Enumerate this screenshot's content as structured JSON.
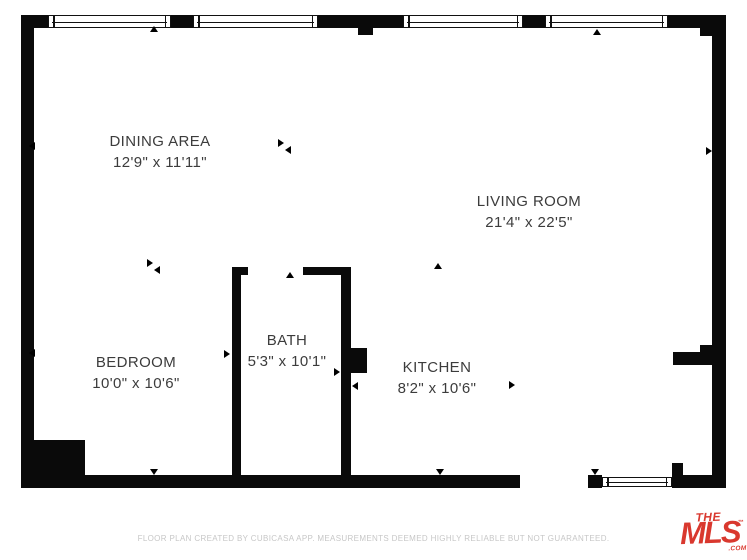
{
  "plan": {
    "rooms": [
      {
        "name": "DINING AREA",
        "dims": "12'9\" x 11'11\""
      },
      {
        "name": "LIVING ROOM",
        "dims": "21'4\" x 22'5\""
      },
      {
        "name": "BEDROOM",
        "dims": "10'0\" x 10'6\""
      },
      {
        "name": "BATH",
        "dims": "5'3\" x 10'1\""
      },
      {
        "name": "KITCHEN",
        "dims": "8'2\" x 10'6\""
      }
    ]
  },
  "footer": {
    "disclaimer": "FLOOR PLAN CREATED BY CUBICASA APP. MEASUREMENTS DEEMED HIGHLY RELIABLE BUT NOT GUARANTEED."
  },
  "logo": {
    "the": "THE",
    "mls": "MLS",
    "tm": "™",
    "com": ".COM"
  },
  "colors": {
    "wall": "#0a0a0a",
    "background": "#ffffff",
    "label_text": "#3c3c3c",
    "footer_text": "#c7c7c7",
    "logo_red": "#d9382e"
  }
}
